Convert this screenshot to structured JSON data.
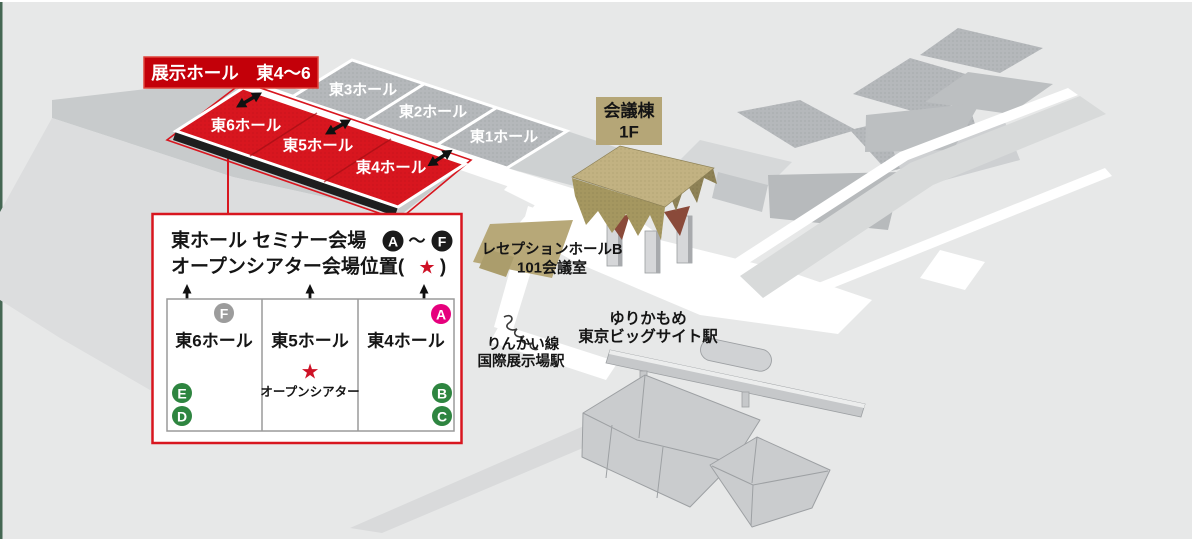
{
  "map": {
    "tag_label": "展示ホール　東4～6",
    "gray_halls": [
      "東3ホール",
      "東2ホール",
      "東1ホール"
    ],
    "red_halls": [
      "東6ホール",
      "東5ホール",
      "東4ホール"
    ],
    "conference_label": {
      "line1": "会議棟",
      "line2": "1F"
    },
    "reception_label": {
      "line1": "レセプションホールB",
      "line2": "101会議室"
    },
    "station_yurikamome": {
      "line1": "ゆりかもめ",
      "line2": "東京ビッグサイト駅"
    },
    "station_rinkai": {
      "line1": "りんかい線",
      "line2": "国際展示場駅"
    }
  },
  "legend": {
    "title_line1": {
      "text": "東ホール セミナー会場",
      "badge_start": "A",
      "tilde": "～",
      "badge_end": "F"
    },
    "title_line2": {
      "prefix": "オープンシアター会場位置(",
      "star": "★",
      "suffix": ")"
    },
    "halls": [
      "東6ホール",
      "東5ホール",
      "東4ホール"
    ],
    "open_theater": {
      "star": "★",
      "label": "オープンシアター"
    },
    "badges": {
      "f": "F",
      "a": "A",
      "e": "E",
      "d": "D",
      "b": "B",
      "c": "C"
    }
  },
  "colors": {
    "red": "#d8161f",
    "dark_red_tag": "#c30009",
    "black_edge": "#1e1e1e",
    "tan": "#b5a677",
    "green_badge": "#2e8540",
    "pink_badge": "#e6007d",
    "gray_badge": "#9c9c9c",
    "badge_black": "#1a1a1a",
    "star_red": "#ce1126"
  }
}
